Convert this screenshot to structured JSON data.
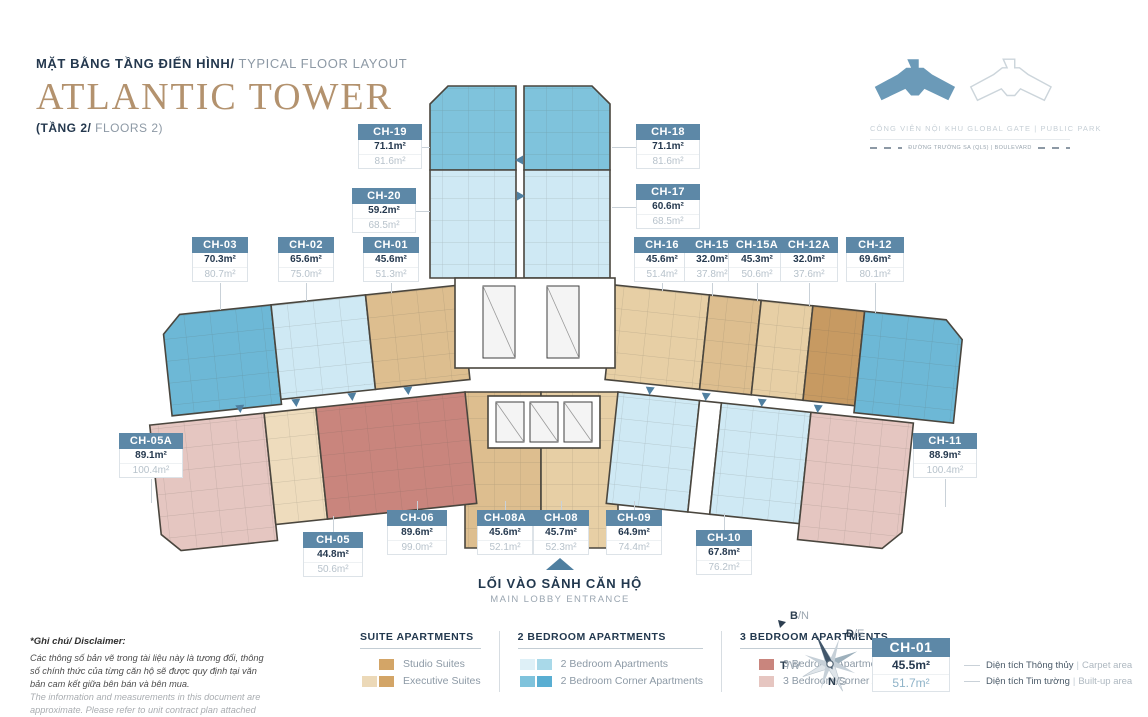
{
  "header": {
    "subtitle_vi": "MẶT BẰNG TẦNG ĐIỂN HÌNH/",
    "subtitle_en": " TYPICAL FLOOR LAYOUT",
    "title": "ATLANTIC TOWER",
    "floor_vi": "(TẦNG 2/",
    "floor_en": " FLOORS 2)"
  },
  "site": {
    "park_label": "CÔNG VIÊN NỘI KHU GLOBAL GATE | PUBLIC PARK",
    "road_label": "ĐƯỜNG TRƯỜNG SA (QL5) | BOULEVARD"
  },
  "entrance": {
    "vi": "LỐI VÀO SẢNH CĂN HỘ",
    "en": "MAIN LOBBY ENTRANCE"
  },
  "units": [
    {
      "id": "CH-19",
      "carpet": "71.1m²",
      "builtup": "81.6m²",
      "type": "2br_corner"
    },
    {
      "id": "CH-18",
      "carpet": "71.1m²",
      "builtup": "81.6m²",
      "type": "2br_corner"
    },
    {
      "id": "CH-20",
      "carpet": "59.2m²",
      "builtup": "68.5m²",
      "type": "2br"
    },
    {
      "id": "CH-17",
      "carpet": "60.6m²",
      "builtup": "68.5m²",
      "type": "2br"
    },
    {
      "id": "CH-03",
      "carpet": "70.3m²",
      "builtup": "80.7m²",
      "type": "2br_corner_dark"
    },
    {
      "id": "CH-02",
      "carpet": "65.6m²",
      "builtup": "75.0m²",
      "type": "2br"
    },
    {
      "id": "CH-01",
      "carpet": "45.6m²",
      "builtup": "51.3m²",
      "type": "studio"
    },
    {
      "id": "CH-16",
      "carpet": "45.6m²",
      "builtup": "51.4m²",
      "type": "studio_light"
    },
    {
      "id": "CH-15",
      "carpet": "32.0m²",
      "builtup": "37.8m²",
      "type": "studio"
    },
    {
      "id": "CH-15A",
      "carpet": "45.3m²",
      "builtup": "50.6m²",
      "type": "studio_light"
    },
    {
      "id": "CH-12A",
      "carpet": "32.0m²",
      "builtup": "37.6m²",
      "type": "executive"
    },
    {
      "id": "CH-12",
      "carpet": "69.6m²",
      "builtup": "80.1m²",
      "type": "2br_corner_dark"
    },
    {
      "id": "CH-05A",
      "carpet": "89.1m²",
      "builtup": "100.4m²",
      "type": "3br_corner"
    },
    {
      "id": "CH-11",
      "carpet": "88.9m²",
      "builtup": "100.4m²",
      "type": "3br_corner"
    },
    {
      "id": "CH-05",
      "carpet": "44.8m²",
      "builtup": "50.6m²",
      "type": "executive_light"
    },
    {
      "id": "CH-06",
      "carpet": "89.6m²",
      "builtup": "99.0m²",
      "type": "3br"
    },
    {
      "id": "CH-08A",
      "carpet": "45.6m²",
      "builtup": "52.1m²",
      "type": "studio"
    },
    {
      "id": "CH-08",
      "carpet": "45.7m²",
      "builtup": "52.3m²",
      "type": "studio_light"
    },
    {
      "id": "CH-09",
      "carpet": "64.9m²",
      "builtup": "74.4m²",
      "type": "2br"
    },
    {
      "id": "CH-10",
      "carpet": "67.8m²",
      "builtup": "76.2m²",
      "type": "2br"
    }
  ],
  "plan_colors": {
    "2br": "#cfe9f4",
    "2br_corner": "#7fc3dc",
    "2br_corner_dark": "#6db8d6",
    "studio": "#ddbe8f",
    "studio_light": "#e7cfa5",
    "executive": "#c79a62",
    "executive_light": "#eedcbd",
    "3br": "#c9857d",
    "3br_corner": "#e5c6c1",
    "label_header": "#5d88a7",
    "accent": "#4f7fa0",
    "wall": "#4a463e"
  },
  "legend": {
    "groups": [
      {
        "title": "SUITE APARTMENTS",
        "items": [
          {
            "label": "Studio Suites",
            "swatches": [
              "#d3a567"
            ]
          },
          {
            "label": "Executive Suites",
            "swatches": [
              "#ecd9b8",
              "#d3a567"
            ]
          }
        ]
      },
      {
        "title": "2 BEDROOM APARTMENTS",
        "items": [
          {
            "label": "2 Bedroom Apartments",
            "swatches": [
              "#def0f7",
              "#a9d9e9"
            ]
          },
          {
            "label": "2 Bedroom Corner Apartments",
            "swatches": [
              "#7fc3dc",
              "#59aed2"
            ]
          }
        ]
      },
      {
        "title": "3 BEDROOM APARTMENTS",
        "items": [
          {
            "label": "3 Bedroom Apartments",
            "swatches": [
              "#c9857d"
            ]
          },
          {
            "label": "3 Bedroom Corner Apartments",
            "swatches": [
              "#e6c6c1"
            ]
          }
        ]
      }
    ]
  },
  "compass": {
    "n": {
      "bold": "B",
      "rest": "/N"
    },
    "e": {
      "bold": "Đ",
      "rest": "/E"
    },
    "s": {
      "bold": "N",
      "rest": "/S"
    },
    "w": {
      "bold": "T",
      "rest": "/W"
    }
  },
  "key_sample": {
    "id": "CH-01",
    "carpet": "45.5m²",
    "builtup": "51.7m²",
    "carpet_vi": "Diện tích Thông thủy",
    "carpet_en": "Carpet area",
    "builtup_vi": "Diện tích Tim tường",
    "builtup_en": "Built-up area",
    "pipe": "|"
  },
  "disclaimer": {
    "title": "*Ghi chú/ Disclaimer:",
    "vi": "Các thông số bản vẽ trong tài liệu này là tương đối, thông số chính thức của từng căn hộ sẽ được quy định tại văn bản cam kết giữa bên bán và bên mua.",
    "en": "The information and measurements in this document are approximate. Please refer to unit contract plan attached with SPA (Sales and Purchase agreement)."
  }
}
